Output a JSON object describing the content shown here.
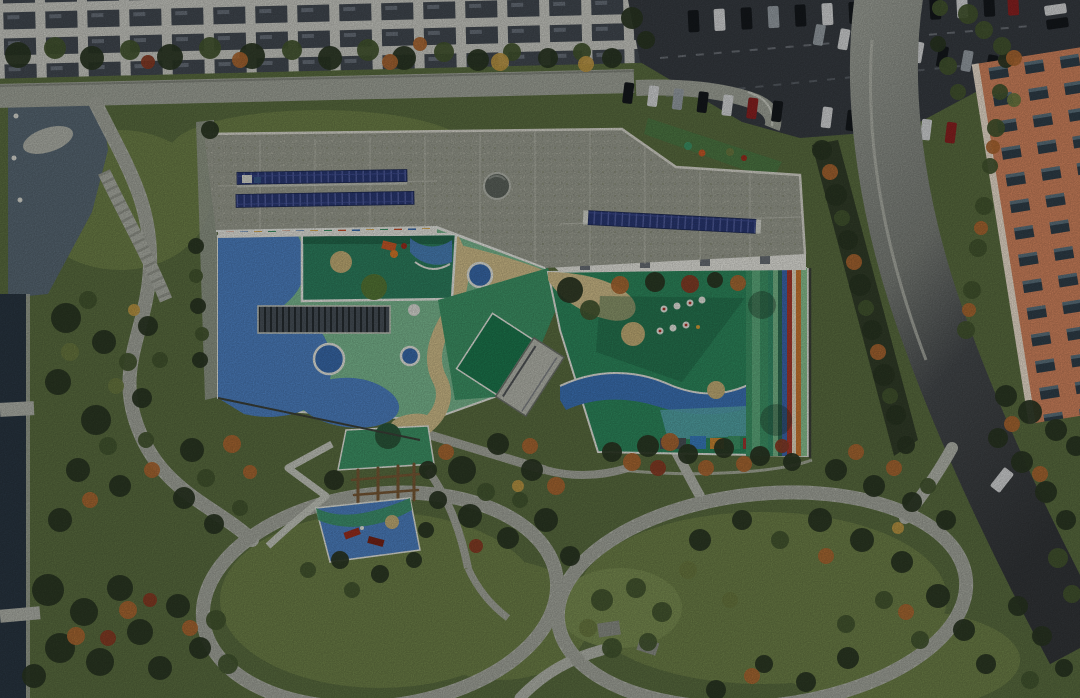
{
  "scene": {
    "type": "aerial-photograph",
    "subject": "Top-down drone view of an angular kindergarten building with a gravel roof, rooftop solar arrays, sunken play courtyard, colorful rubber play yards with circles, sand paths and a rainbow stripe track, surrounded by an autumn park with looping walkways, a water channel, a street with apartment blocks, a car park and an orange residential tower",
    "season": "autumn",
    "time_of_day": "daytime"
  },
  "palette": {
    "park_base": "#5c6f41",
    "lawn": "#6f8249",
    "lawn_bright": "#7c9053",
    "terrace_green": "#4f7a45",
    "tree_dark": "#2c3824",
    "tree_green": "#465831",
    "tree_olive": "#6d7c42",
    "tree_autumn": "#b06a33",
    "tree_red": "#8c3c25",
    "tree_yellow": "#c29b46",
    "path": "#b7bab0",
    "path_joint": "#979b90",
    "road_top": "#a3a79c",
    "concrete": "#b3b6ad",
    "gravel": "#9aa095",
    "asphalt": "#383d43",
    "lane": "#8d939b",
    "water": "#2a3743",
    "pond": "#5a6a76",
    "grid_light": "#cdcec7",
    "roof": "#9da093",
    "parapet": "#dcdbd1",
    "roof_seam": "#c6c7bb",
    "solar": "#2b3a76",
    "dome": "#5f665f",
    "facade": "#e9e9e2",
    "facade_accents": [
      "#c94f2a",
      "#3a6cae",
      "#d9a23a",
      "#3f9668"
    ],
    "courtyard": "#2e8160",
    "courtyard_hill": "#577a37",
    "play_green_light": "#7cbb92",
    "play_green": "#3f9668",
    "play_green_deep": "#2e8a5e",
    "play_blue": "#4e82c4",
    "play_blue_deep": "#3a6cae",
    "wave_blue": "#3d74b8",
    "sand": "#d3c08c",
    "tan": "#c7b279",
    "white_line": "#e9ebe3",
    "ramp_green": "#1d7a4f",
    "walk_gray": "#b9bbb1",
    "pergola": "#49525a",
    "teal_pool": "#58a7af",
    "rainbow": [
      "#37906a",
      "#79b98b",
      "#2f6e54",
      "#3e68b0",
      "#ab3a2e",
      "#e7ddc4",
      "#cd7a33",
      "#8cc492"
    ],
    "hedge_dark": "#333f2a",
    "building_orange": "#d5865f",
    "building_edge": "#f0e3d2",
    "shed": "#8e9289",
    "wood": "#7a5a36",
    "car_white": "#d9dbdc",
    "car_black": "#15191d",
    "car_silver": "#9aa2a8",
    "car_red": "#8e2222",
    "car_blue": "#2c4a7c",
    "equip_orange": "#cc5a28",
    "equip_red": "#9e2f1f"
  },
  "features": {
    "residential_block": "apartment building rooftops along top edge",
    "street": "tree-lined street",
    "parking_lot": "surface car park with parked cars",
    "access_road": "curving access road on the right",
    "orange_tower": "orange residential tower, top right",
    "kindergarten_roof": "angular gravel roof with photovoltaic arrays and circular skylight",
    "inner_courtyard": "sunken play courtyard",
    "west_play_yard": "blue-green play yard with ringed circles, sand paths and pergola",
    "east_play_yard": "green play yard with wave band, play tables and rainbow stripe track",
    "outdoor_play_corner": "climbing frame with green and blue play mats",
    "park": "landscaped park with looping stone paths",
    "water_channel": "pond and linear water channel on the left"
  }
}
